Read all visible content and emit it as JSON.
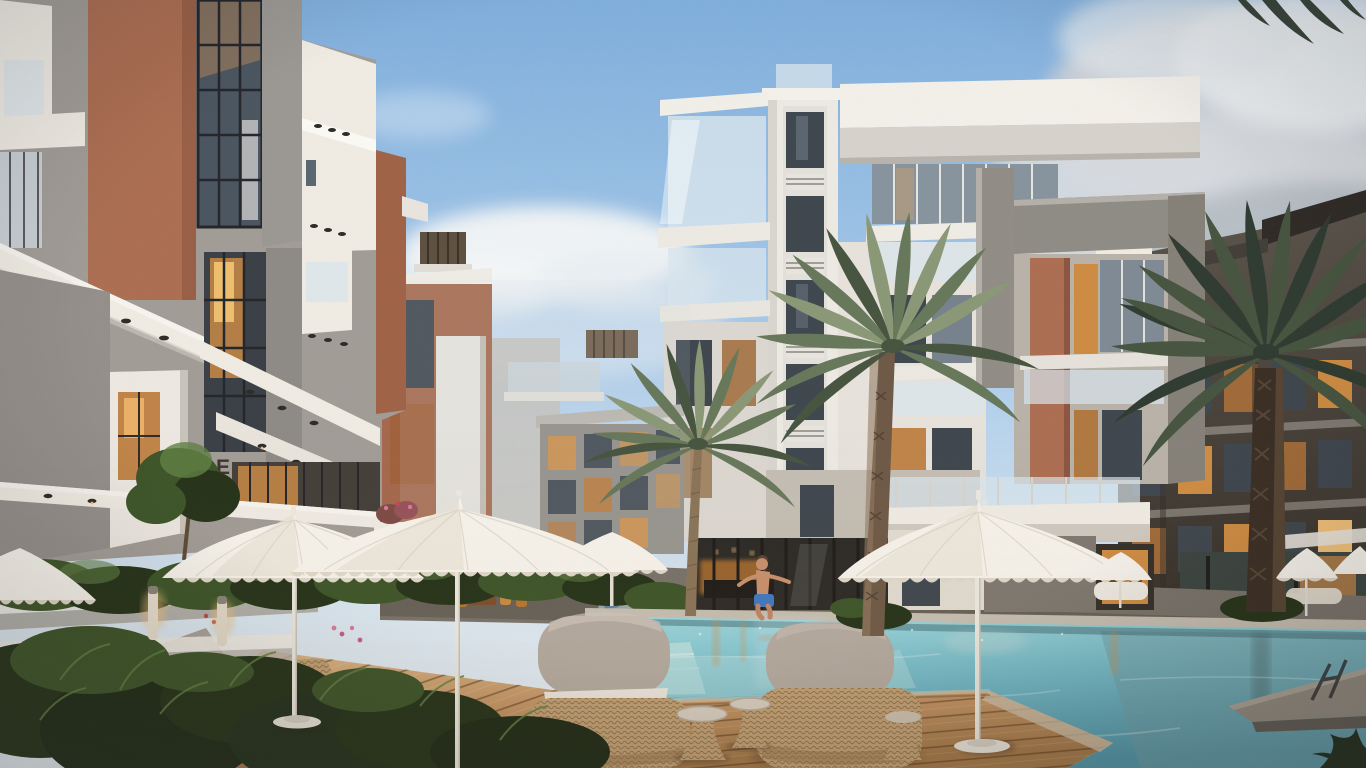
{
  "scene": {
    "type": "3d-architectural-render",
    "setting": "Dusk courtyard of a modern residential compound: apartment buildings with glass balconies around a turquoise swimming pool, white fringed umbrellas, wicker lounge furniture on a wooden deck, palm trees, and a boy jumping into the pool",
    "building_label": "E",
    "elements": [
      "apartment-buildings",
      "swimming-pool",
      "palm-trees",
      "pool-umbrellas",
      "wicker-lounge-chairs",
      "wooden-deck",
      "planted-hedges",
      "boy-jumping-into-pool",
      "bollard-lights",
      "lit-interiors",
      "stone-jetty",
      "pool-ladder"
    ]
  },
  "colors": {
    "sky_top": "#7FAEDC",
    "sky_mid": "#A9CBEA",
    "sky_low": "#DCE9F3",
    "cloud_white": "#F3F5F6",
    "cloud_gray": "#C9CED4",
    "cloud_dark": "#AEB5BD",
    "facade_white": "#F0ECE4",
    "facade_cream": "#E2DCD1",
    "facade_gray": "#A19C96",
    "stucco_dark": "#857F79",
    "brick": "#AC6E52",
    "brick_dark": "#8C5540",
    "dark_building": "#4C463F",
    "dark_deep": "#352F29",
    "window_warm": "#CE8C42",
    "window_glow": "#F2C178",
    "glass_cool": "#76828C",
    "glass_dark": "#3E464E",
    "glass_balcony": "#D9E6EE",
    "frame_dark": "#2A2A2C",
    "pool_light": "#9ED8DE",
    "pool_mid": "#74BCCB",
    "pool_deep": "#4E96A8",
    "pool_right": "#6E9BA4",
    "coping": "#C6BFB2",
    "paving": "#78726A",
    "deck": "#C49464",
    "deck_light": "#DCB887",
    "deck_dark": "#8A6038",
    "green_dark": "#243218",
    "green_mid": "#3C5428",
    "green_light": "#5F7F42",
    "palm_light": "#8A9876",
    "palm_mid": "#67775A",
    "palm_dark": "#46543F",
    "palm_deep": "#2F3B30",
    "trunk_light": "#8A7458",
    "trunk_dark": "#584430",
    "umbrella_white": "#F7F4ED",
    "umbrella_shade": "#DFD8C9",
    "wicker": "#C2A175",
    "wicker_dark": "#96744A",
    "cushion": "#B4AAA0",
    "cushion_dark": "#8F857B",
    "skin": "#C9906C",
    "shorts_blue": "#3E78C0"
  }
}
